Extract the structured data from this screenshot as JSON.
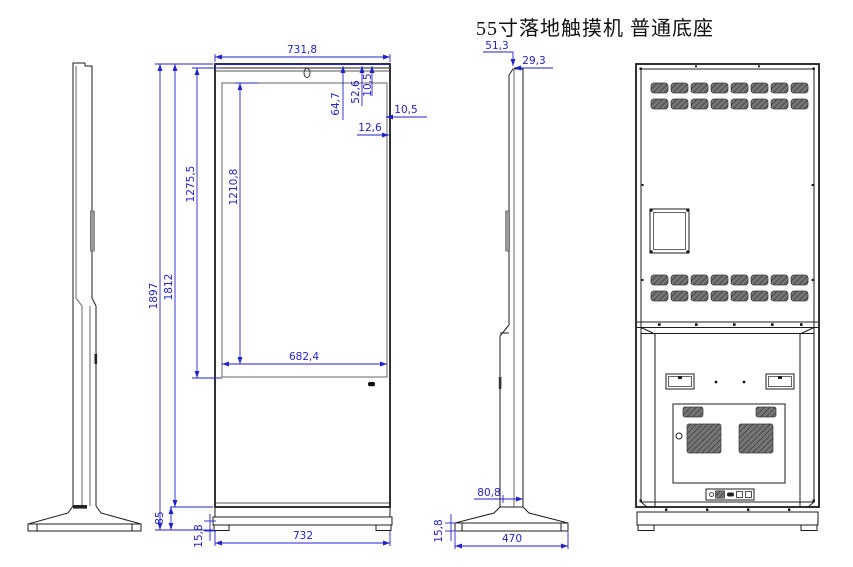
{
  "title": "55寸落地触摸机 普通底座",
  "colors": {
    "dimension_blue": "#2222cc",
    "line_color": "#1c1c1c"
  },
  "dimensions": {
    "front": {
      "overall_width_top": "731,8",
      "display_width": "682,4",
      "overall_height": "1897",
      "cabinet_height": "1812",
      "glass_height": "1275,5",
      "display_height": "1210,8",
      "top_offset_a": "64,7",
      "top_offset_b": "52,6",
      "top_offset_c": "10,5",
      "right_bezel": "10,5",
      "edge_offset": "12,6",
      "base_section_height": "85",
      "base_plate_height": "15,8",
      "overall_width_bottom": "732"
    },
    "side": {
      "top_depth_total": "51,3",
      "top_depth_screen": "29,3",
      "body_depth_bottom": "80,8",
      "base_plate_height": "15,8",
      "base_depth": "470"
    }
  }
}
